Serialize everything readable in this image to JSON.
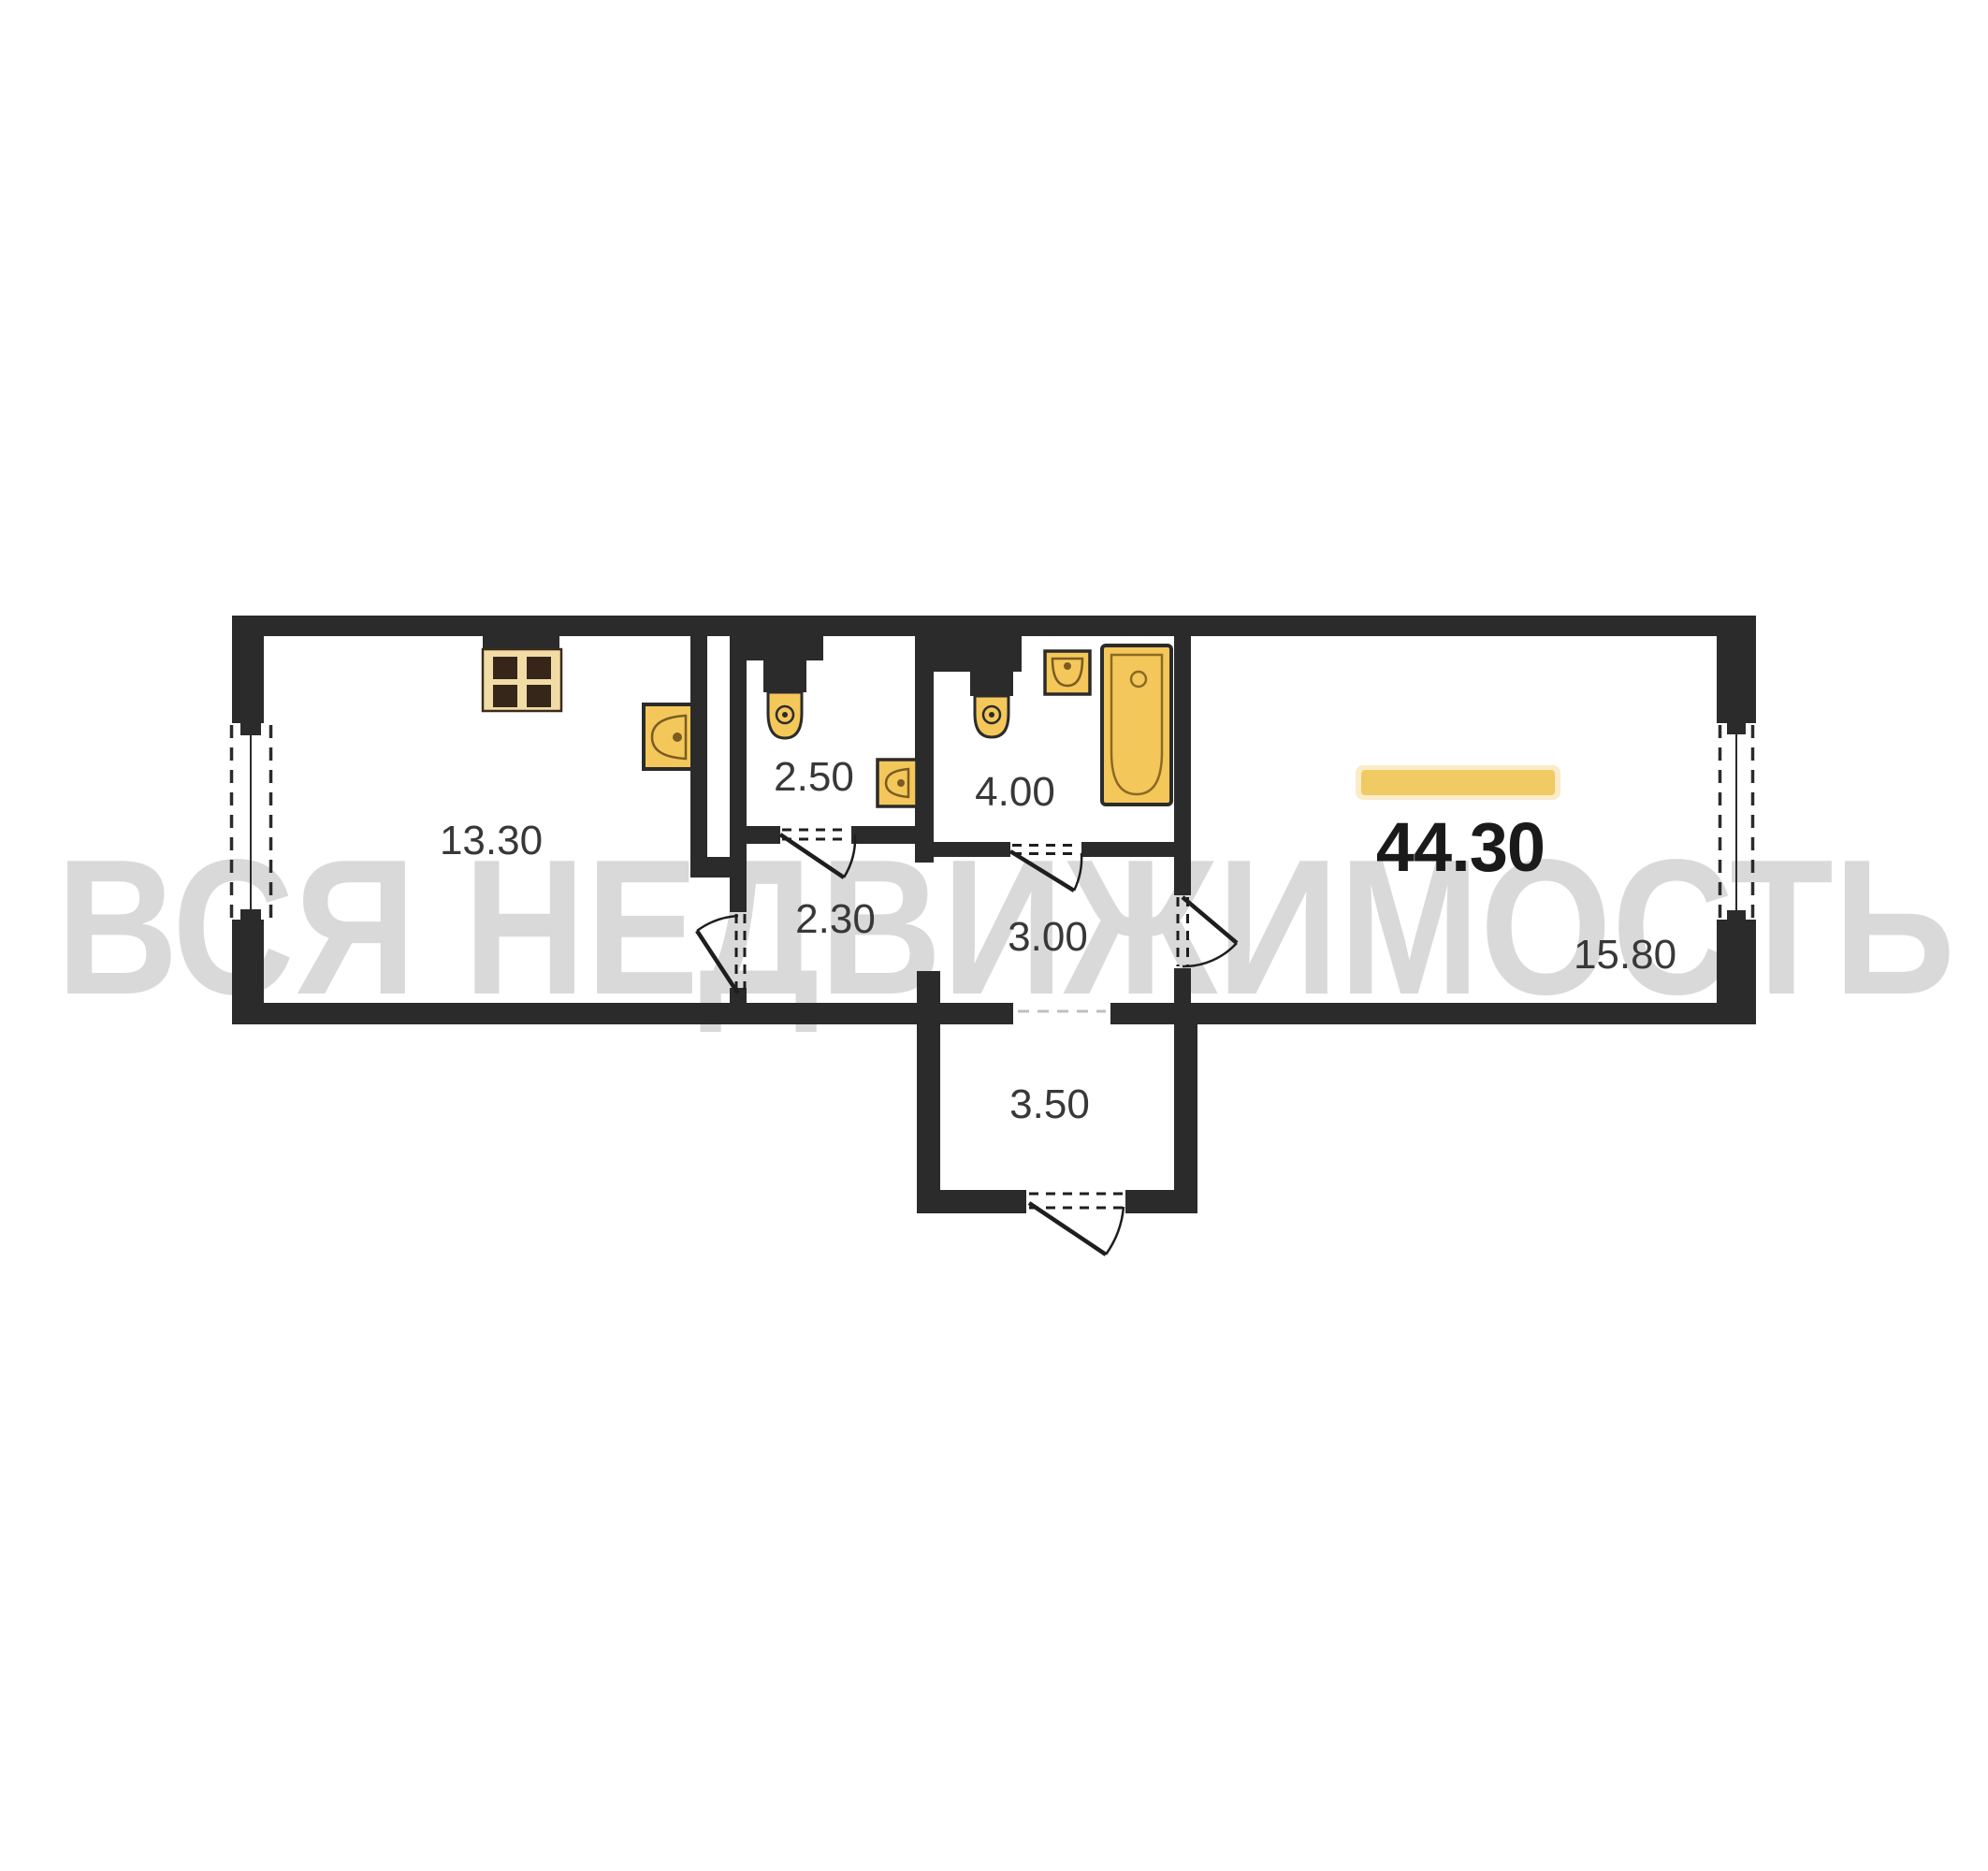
{
  "plan": {
    "watermark": "ВСЯ НЕДВИЖИМОСТЬ",
    "total_area": "44.30",
    "rooms": {
      "kitchen": "13.30",
      "wc": "2.50",
      "bathroom": "4.00",
      "hall": "2.30",
      "corridor": "3.00",
      "living_room": "15.80",
      "entry": "3.50"
    },
    "colors": {
      "wall": "#2b2b2b",
      "fixture_fill": "#f4c75a",
      "fixture_light": "#f2dca6",
      "burner": "#36261a",
      "fixture_line": "#7a5c22",
      "label": "#383838",
      "total_label": "#1a1a1a",
      "highlight_bar": "#f0ca63",
      "highlight_glow": "#f5dc9b",
      "watermark": "#d9d9d9"
    }
  }
}
